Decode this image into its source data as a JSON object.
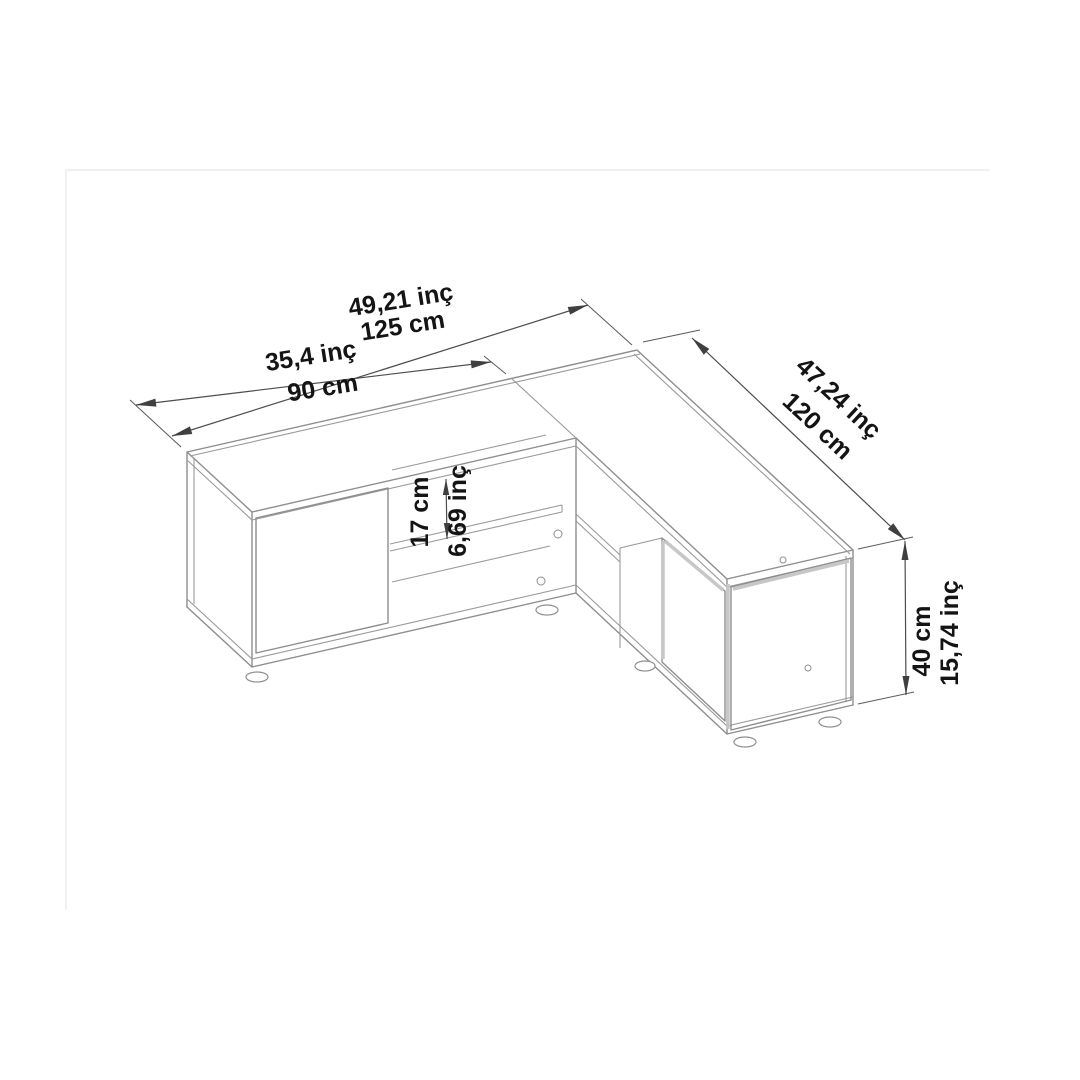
{
  "page": {
    "background_color": "#ffffff",
    "frame_color": "#ececec",
    "drawing_line_color": "#8e8e8e",
    "dimension_line_color": "#4d4d4d",
    "text_color": "#141414"
  },
  "drawing": {
    "kind": "isometric-furniture-dimension-drawing",
    "object": "l-shaped-corner-tv-stand",
    "dimensions": {
      "total_width": {
        "inch": "49,21 inç",
        "cm": "125 cm"
      },
      "left_wing": {
        "inch": "35,4 inç",
        "cm": "90 cm"
      },
      "right_wing": {
        "inch": "47,24 inç",
        "cm": "120 cm"
      },
      "shelf_gap": {
        "inch": "6,69 inç",
        "cm": "17 cm"
      },
      "height": {
        "inch": "15,74 inç",
        "cm": "40 cm"
      }
    }
  }
}
